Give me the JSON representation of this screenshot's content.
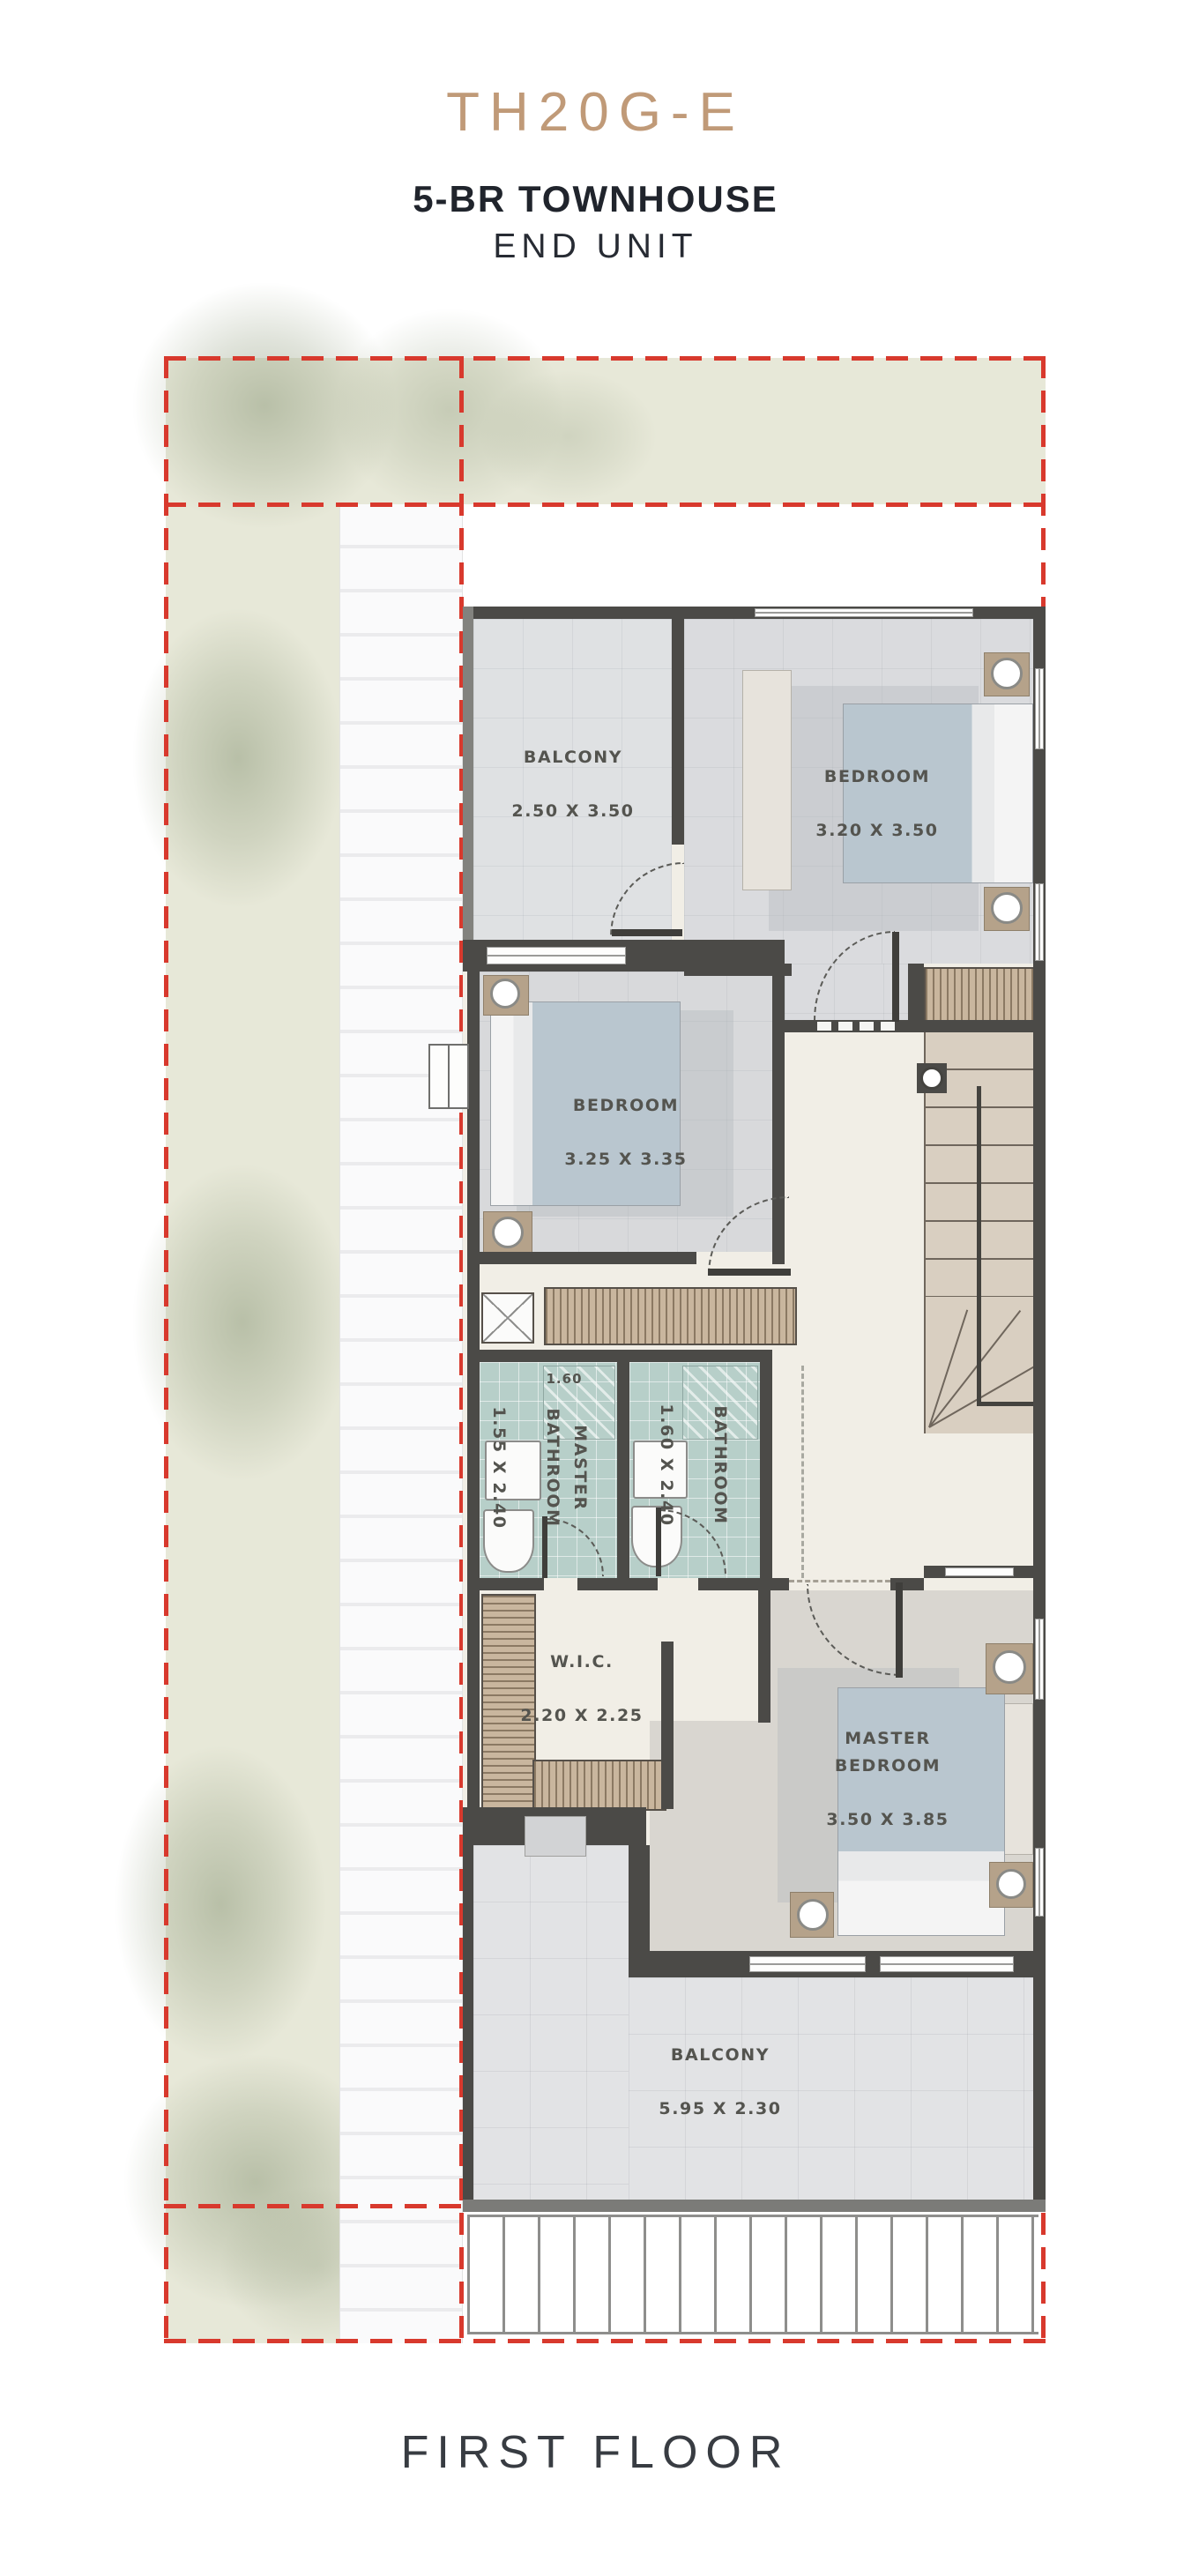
{
  "header": {
    "unit_code": "TH20G-E",
    "unit_type": "5-BR TOWNHOUSE",
    "unit_variant": "END UNIT"
  },
  "footer": {
    "floor_label": "FIRST FLOOR"
  },
  "plan": {
    "rooms": [
      {
        "name": "BALCONY",
        "dims": "2.50 X 3.50"
      },
      {
        "name": "BEDROOM",
        "dims": "3.20 X 3.50"
      },
      {
        "name": "BEDROOM",
        "dims": "3.25 X 3.35"
      },
      {
        "name": "MASTER BATHROOM",
        "dims": "1.55 X 2.40"
      },
      {
        "name": "BATHROOM",
        "dims": "1.60 X 2.40"
      },
      {
        "name": "W.I.C.",
        "dims": "2.20 X 2.25"
      },
      {
        "name": "MASTER BEDROOM",
        "dims": "3.50 X 3.85"
      },
      {
        "name": "BALCONY",
        "dims": "5.95 X 2.30"
      }
    ],
    "annotations": {
      "dimension_note": "1.60"
    }
  },
  "palette": {
    "accent_title": "#c09a78",
    "heading_text": "#20242c",
    "label_text": "#54544f",
    "boundary_red": "#d8392d",
    "wall": "#4b4a47",
    "bathroom_floor": "#b7cfc9",
    "garden": "#e7e8d8",
    "stairs": "#d9cfc1"
  }
}
